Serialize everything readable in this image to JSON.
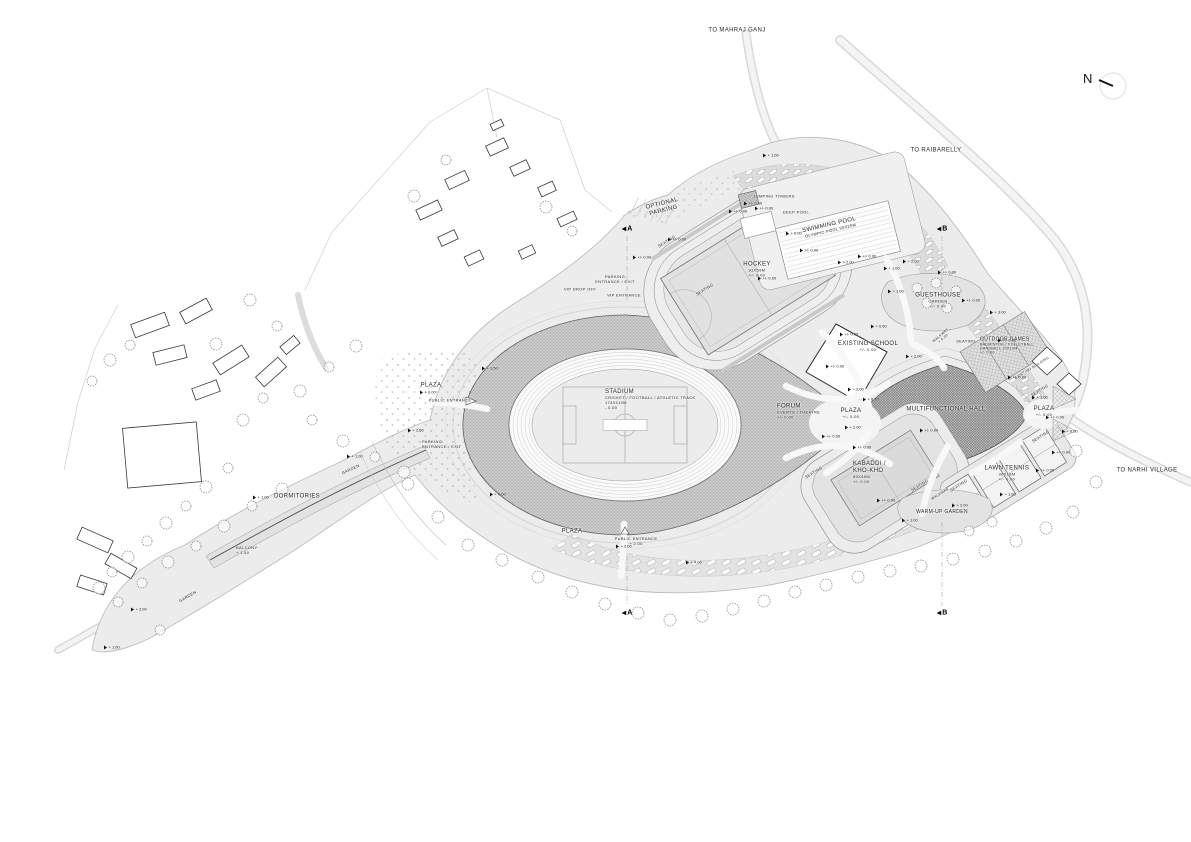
{
  "title": "Sports Complex Site Plan",
  "colors": {
    "paper": "#ffffff",
    "site": "#ececec",
    "road": "#f2f2f2",
    "outline": "#9a9a9a",
    "hatch": "#8f8f8f",
    "ink": "#1c1c1c",
    "treestroke": "#8f8f8f"
  },
  "north": {
    "label": "N"
  },
  "plan": {
    "labels": [
      {
        "id": "to-mahraj-ganj",
        "x": 737,
        "y": 31,
        "rot": 0,
        "lines": [
          [
            "TO MAHRAJ GANJ",
            6
          ]
        ]
      },
      {
        "id": "to-raibarelly",
        "x": 936,
        "y": 151,
        "rot": 0,
        "lines": [
          [
            "TO RAIBARELLY",
            6
          ]
        ]
      },
      {
        "id": "optional-parking",
        "x": 663,
        "y": 208,
        "rot": -14,
        "lines": [
          [
            "OPTIONAL",
            6
          ],
          [
            "PARKING",
            6
          ]
        ]
      },
      {
        "id": "parking-entrance-exit-north",
        "x": 615,
        "y": 280,
        "rot": 0,
        "lines": [
          [
            "PARKING",
            4
          ],
          [
            "ENTRANCE / EXIT",
            4
          ]
        ]
      },
      {
        "id": "vip-drop-off",
        "x": 580,
        "y": 290,
        "rot": 0,
        "lines": [
          [
            "VIP DROP OFF",
            4
          ]
        ]
      },
      {
        "id": "vip-entrance",
        "x": 624,
        "y": 296,
        "rot": 0,
        "lines": [
          [
            "VIP ENTRANCE",
            4
          ]
        ]
      },
      {
        "id": "seating-hockey-nw",
        "x": 667,
        "y": 242,
        "rot": -32,
        "lines": [
          [
            "SEATING",
            4
          ]
        ]
      },
      {
        "id": "seating-hockey-sw",
        "x": 705,
        "y": 290,
        "rot": -32,
        "lines": [
          [
            "SEATING",
            4
          ]
        ]
      },
      {
        "id": "jumping-towers",
        "x": 774,
        "y": 197,
        "rot": 0,
        "lines": [
          [
            "JUMPING TOWERS",
            4
          ]
        ]
      },
      {
        "id": "deep-pool",
        "x": 796,
        "y": 213,
        "rot": 0,
        "lines": [
          [
            "DEEP POOL",
            4
          ]
        ]
      },
      {
        "id": "swimming-pool",
        "x": 830,
        "y": 228,
        "rot": -13,
        "lines": [
          [
            "SWIMMING POOL",
            6
          ],
          [
            "OLYMPIC POOL 50X25M",
            4
          ]
        ]
      },
      {
        "id": "hockey",
        "x": 757,
        "y": 270,
        "rot": 0,
        "lines": [
          [
            "HOCKEY",
            6
          ],
          [
            "91X55M",
            4
          ],
          [
            "+/- 0.00",
            4
          ]
        ]
      },
      {
        "id": "guesthouse",
        "x": 938,
        "y": 301,
        "rot": 0,
        "lines": [
          [
            "GUESTHOUSE",
            6
          ],
          [
            "GARDEN",
            4
          ],
          [
            "+/- 0.00",
            4
          ]
        ]
      },
      {
        "id": "outdoor-games",
        "x": 980,
        "y": 346,
        "rot": 0,
        "align": "left",
        "lines": [
          [
            "OUTDOOR GAMES",
            5
          ],
          [
            "BADMINTON / VOLLEYBALL",
            3.5
          ],
          [
            "HANDBALL 20X10M",
            3.5
          ],
          [
            "+/- 0.00",
            3.5
          ]
        ]
      },
      {
        "id": "existing-building",
        "x": 1032,
        "y": 368,
        "rot": -32,
        "lines": [
          [
            "EXISTING BUILDING",
            3.5
          ]
        ]
      },
      {
        "id": "existing-school",
        "x": 868,
        "y": 347,
        "rot": 0,
        "lines": [
          [
            "EXISTING SCHOOL",
            6
          ],
          [
            "+/- 0.00",
            4
          ]
        ]
      },
      {
        "id": "multifunctional-hall",
        "x": 946,
        "y": 410,
        "rot": 0,
        "lines": [
          [
            "MULTIFUNCTIONAL HALL",
            6
          ]
        ]
      },
      {
        "id": "stadium",
        "x": 605,
        "y": 400,
        "rot": 0,
        "align": "left",
        "lines": [
          [
            "STADIUM",
            6
          ],
          [
            "CRICKET / FOOTBALL / ATHLETIC TRACK",
            4
          ],
          [
            "174X110M",
            4
          ],
          [
            "- 0.00",
            4
          ]
        ]
      },
      {
        "id": "forum",
        "x": 777,
        "y": 412,
        "rot": 0,
        "align": "left",
        "lines": [
          [
            "FORUM",
            6
          ],
          [
            "EVENTS / THEATRE",
            4
          ],
          [
            "+/- 0.00",
            4
          ]
        ]
      },
      {
        "id": "plaza-forum",
        "x": 851,
        "y": 414,
        "rot": 0,
        "lines": [
          [
            "PLAZA",
            6
          ],
          [
            "+/- 0.00",
            4
          ]
        ]
      },
      {
        "id": "plaza-east",
        "x": 1044,
        "y": 412,
        "rot": 0,
        "lines": [
          [
            "PLAZA",
            6
          ],
          [
            "+/- 0.00",
            4
          ]
        ]
      },
      {
        "id": "kabaddi",
        "x": 853,
        "y": 473,
        "rot": 0,
        "align": "left",
        "lines": [
          [
            "KABADDI /",
            6
          ],
          [
            "KHO-KHO",
            6
          ],
          [
            "50X40M",
            4
          ],
          [
            "+/- 0.00",
            4
          ]
        ]
      },
      {
        "id": "lawn-tennis",
        "x": 1007,
        "y": 474,
        "rot": 0,
        "lines": [
          [
            "LAWN TENNIS",
            6
          ],
          [
            "36X18M",
            4
          ],
          [
            "+/- 0.00",
            4
          ]
        ]
      },
      {
        "id": "warm-up-garden",
        "x": 942,
        "y": 512,
        "rot": 0,
        "lines": [
          [
            "WARM-UP GARDEN",
            5
          ]
        ]
      },
      {
        "id": "seating-kabaddi-west",
        "x": 814,
        "y": 473,
        "rot": -32,
        "lines": [
          [
            "SEATING",
            4
          ]
        ]
      },
      {
        "id": "seating-kabaddi-east",
        "x": 920,
        "y": 486,
        "rot": -32,
        "lines": [
          [
            "SEATING",
            4
          ]
        ]
      },
      {
        "id": "seating-tennis",
        "x": 959,
        "y": 486,
        "rot": -32,
        "lines": [
          [
            "SEATING",
            4
          ]
        ]
      },
      {
        "id": "walkway-kabaddi",
        "x": 940,
        "y": 494,
        "rot": -32,
        "lines": [
          [
            "WALKWAY",
            3.5
          ]
        ]
      },
      {
        "id": "walkway-guesthouse",
        "x": 942,
        "y": 337,
        "rot": -40,
        "lines": [
          [
            "WALKWAY",
            3.5
          ],
          [
            "+ 0.00",
            3.5
          ]
        ]
      },
      {
        "id": "seating-guesthouse",
        "x": 966,
        "y": 342,
        "rot": 0,
        "lines": [
          [
            "SEATING",
            4
          ]
        ]
      },
      {
        "id": "seating-hall-northeast",
        "x": 1040,
        "y": 391,
        "rot": -32,
        "lines": [
          [
            "SEATING",
            4
          ]
        ]
      },
      {
        "id": "seating-hall-southeast",
        "x": 1041,
        "y": 437,
        "rot": -32,
        "lines": [
          [
            "SEATING",
            4
          ]
        ]
      },
      {
        "id": "plaza-west",
        "x": 431,
        "y": 386,
        "rot": 0,
        "lines": [
          [
            "PLAZA",
            6
          ]
        ]
      },
      {
        "id": "public-entrance-west",
        "x": 450,
        "y": 401,
        "rot": 0,
        "lines": [
          [
            "PUBLIC ENTRANCE",
            4
          ]
        ]
      },
      {
        "id": "parking-entrance-exit-west",
        "x": 422,
        "y": 445,
        "rot": 0,
        "align": "left",
        "lines": [
          [
            "PARKING",
            4
          ],
          [
            "ENTRANCE / EXIT",
            4
          ]
        ]
      },
      {
        "id": "dormitories",
        "x": 297,
        "y": 497,
        "rot": 0,
        "lines": [
          [
            "DORMITORIES",
            6
          ]
        ]
      },
      {
        "id": "garden-dormitories",
        "x": 351,
        "y": 470,
        "rot": -25,
        "lines": [
          [
            "GARDEN",
            4
          ]
        ]
      },
      {
        "id": "balcony",
        "x": 236,
        "y": 551,
        "rot": 0,
        "align": "left",
        "lines": [
          [
            "BALCONY",
            4
          ],
          [
            "+ 1.50",
            4
          ]
        ]
      },
      {
        "id": "garden-southwest",
        "x": 188,
        "y": 597,
        "rot": -30,
        "lines": [
          [
            "GARDEN",
            4
          ]
        ]
      },
      {
        "id": "plaza-south",
        "x": 572,
        "y": 532,
        "rot": 0,
        "lines": [
          [
            "PLAZA",
            6
          ]
        ]
      },
      {
        "id": "public-entrance-south",
        "x": 636,
        "y": 542,
        "rot": 0,
        "lines": [
          [
            "PUBLIC ENTRANCE",
            4
          ],
          [
            "+ 2.00",
            4
          ]
        ]
      },
      {
        "id": "to-narhi-village",
        "x": 1147,
        "y": 471,
        "rot": 0,
        "lines": [
          [
            "TO NARHI VILLAGE",
            6
          ]
        ]
      }
    ],
    "spot_levels": [
      [
        763,
        155,
        "+ 1.00"
      ],
      [
        744,
        203,
        "+/- 0.00"
      ],
      [
        786,
        233,
        "+ 0.00"
      ],
      [
        729,
        211,
        "+/- 0.00"
      ],
      [
        668,
        239,
        "+/- 0.00"
      ],
      [
        633,
        257,
        "+/- 0.00"
      ],
      [
        758,
        278,
        "+/- 0.00"
      ],
      [
        800,
        250,
        "+/- 0.00"
      ],
      [
        838,
        262,
        "+ 2.00"
      ],
      [
        858,
        256,
        "+/- 0.00"
      ],
      [
        884,
        268,
        "+ 1.00"
      ],
      [
        903,
        261,
        "+ 2.00"
      ],
      [
        938,
        272,
        "+/- 0.00"
      ],
      [
        888,
        291,
        "+ 1.00"
      ],
      [
        962,
        300,
        "+/- 0.00"
      ],
      [
        990,
        312,
        "+ 3.00"
      ],
      [
        998,
        340,
        "+/- 0.00"
      ],
      [
        871,
        326,
        "+ 0.50"
      ],
      [
        840,
        334,
        "+/- 0.00"
      ],
      [
        906,
        356,
        "+ 2.00"
      ],
      [
        826,
        366,
        "+/- 0.00"
      ],
      [
        848,
        389,
        "+ 2.00"
      ],
      [
        863,
        399,
        "+ 0.70"
      ],
      [
        845,
        427,
        "+ 2.00"
      ],
      [
        822,
        436,
        "+/- 0.00"
      ],
      [
        853,
        447,
        "+/- 0.00"
      ],
      [
        877,
        500,
        "+/- 0.00"
      ],
      [
        902,
        520,
        "+ 1.00"
      ],
      [
        952,
        505,
        "+ 2.00"
      ],
      [
        1000,
        494,
        "+ 1.50"
      ],
      [
        1036,
        470,
        "+/- 0.00"
      ],
      [
        1052,
        452,
        "+/- 0.00"
      ],
      [
        1062,
        431,
        "+ 0.00"
      ],
      [
        1046,
        417,
        "+/- 0.00"
      ],
      [
        1032,
        397,
        "+ 1.00"
      ],
      [
        1008,
        377,
        "+/- 0.00"
      ],
      [
        482,
        368,
        "+ 1.50"
      ],
      [
        420,
        392,
        "+ 0.00"
      ],
      [
        408,
        430,
        "+ 2.50"
      ],
      [
        347,
        456,
        "+ 1.00"
      ],
      [
        253,
        497,
        "+ 1.00"
      ],
      [
        131,
        609,
        "+ 2.00"
      ],
      [
        104,
        647,
        "+ 1.00"
      ],
      [
        490,
        494,
        "+ 0.00"
      ],
      [
        616,
        546,
        "+ 2.00"
      ],
      [
        686,
        562,
        "+ 4.00"
      ],
      [
        755,
        208,
        "+/- 0.00"
      ],
      [
        920,
        430,
        "+/- 0.00"
      ]
    ],
    "section_markers": [
      [
        "A",
        627,
        229
      ],
      [
        "B",
        942,
        229
      ],
      [
        "A",
        627,
        613
      ],
      [
        "B",
        942,
        613
      ]
    ],
    "trees": [
      [
        243,
        420,
        6
      ],
      [
        263,
        398,
        5
      ],
      [
        300,
        391,
        6
      ],
      [
        329,
        367,
        5
      ],
      [
        356,
        346,
        6
      ],
      [
        312,
        420,
        5
      ],
      [
        343,
        441,
        6
      ],
      [
        375,
        457,
        5
      ],
      [
        404,
        472,
        6
      ],
      [
        228,
        468,
        5
      ],
      [
        206,
        487,
        6
      ],
      [
        186,
        506,
        5
      ],
      [
        166,
        523,
        6
      ],
      [
        147,
        541,
        5
      ],
      [
        128,
        557,
        6
      ],
      [
        112,
        572,
        5
      ],
      [
        99,
        588,
        6
      ],
      [
        142,
        583,
        5
      ],
      [
        168,
        562,
        6
      ],
      [
        196,
        546,
        5
      ],
      [
        224,
        526,
        6
      ],
      [
        252,
        506,
        5
      ],
      [
        282,
        489,
        6
      ],
      [
        414,
        196,
        6
      ],
      [
        446,
        160,
        5
      ],
      [
        546,
        207,
        6
      ],
      [
        572,
        231,
        5
      ],
      [
        250,
        300,
        6
      ],
      [
        277,
        326,
        5
      ],
      [
        216,
        344,
        6
      ],
      [
        110,
        360,
        6
      ],
      [
        92,
        381,
        5
      ],
      [
        130,
        345,
        5
      ],
      [
        408,
        484,
        6
      ],
      [
        438,
        517,
        6
      ],
      [
        468,
        545,
        6
      ],
      [
        502,
        560,
        6
      ],
      [
        538,
        577,
        6
      ],
      [
        572,
        592,
        6
      ],
      [
        605,
        604,
        6
      ],
      [
        638,
        613,
        6
      ],
      [
        670,
        620,
        6
      ],
      [
        702,
        616,
        6
      ],
      [
        733,
        609,
        6
      ],
      [
        764,
        601,
        6
      ],
      [
        795,
        592,
        6
      ],
      [
        826,
        585,
        6
      ],
      [
        858,
        577,
        6
      ],
      [
        890,
        571,
        6
      ],
      [
        921,
        566,
        6
      ],
      [
        953,
        559,
        6
      ],
      [
        985,
        551,
        6
      ],
      [
        1016,
        541,
        6
      ],
      [
        1046,
        528,
        6
      ],
      [
        1073,
        512,
        6
      ],
      [
        1096,
        482,
        6
      ],
      [
        1076,
        451,
        6
      ],
      [
        917,
        288,
        5
      ],
      [
        936,
        283,
        5
      ],
      [
        956,
        291,
        5
      ],
      [
        927,
        303,
        5
      ],
      [
        947,
        308,
        5
      ],
      [
        969,
        531,
        5
      ],
      [
        992,
        522,
        5
      ],
      [
        118,
        602,
        5
      ],
      [
        160,
        630,
        5
      ]
    ],
    "buildings": [
      [
        497,
        125,
        12,
        7,
        -25
      ],
      [
        497,
        147,
        20,
        11,
        -25
      ],
      [
        520,
        168,
        18,
        10,
        -25
      ],
      [
        547,
        189,
        16,
        10,
        -25
      ],
      [
        457,
        180,
        22,
        11,
        -25
      ],
      [
        429,
        210,
        24,
        11,
        -25
      ],
      [
        448,
        238,
        18,
        10,
        -25
      ],
      [
        474,
        258,
        17,
        10,
        -25
      ],
      [
        527,
        252,
        15,
        9,
        -25
      ],
      [
        567,
        219,
        18,
        9,
        -25
      ],
      [
        150,
        325,
        36,
        14,
        -20
      ],
      [
        196,
        311,
        30,
        13,
        -28
      ],
      [
        170,
        355,
        32,
        13,
        -14
      ],
      [
        231,
        360,
        34,
        14,
        -32
      ],
      [
        271,
        372,
        30,
        13,
        -42
      ],
      [
        206,
        390,
        26,
        12,
        -20
      ],
      [
        290,
        345,
        18,
        10,
        -40
      ],
      [
        162,
        455,
        74,
        60,
        -5
      ],
      [
        95,
        540,
        34,
        13,
        24
      ],
      [
        121,
        566,
        30,
        12,
        30
      ],
      [
        92,
        585,
        28,
        12,
        18
      ]
    ]
  }
}
